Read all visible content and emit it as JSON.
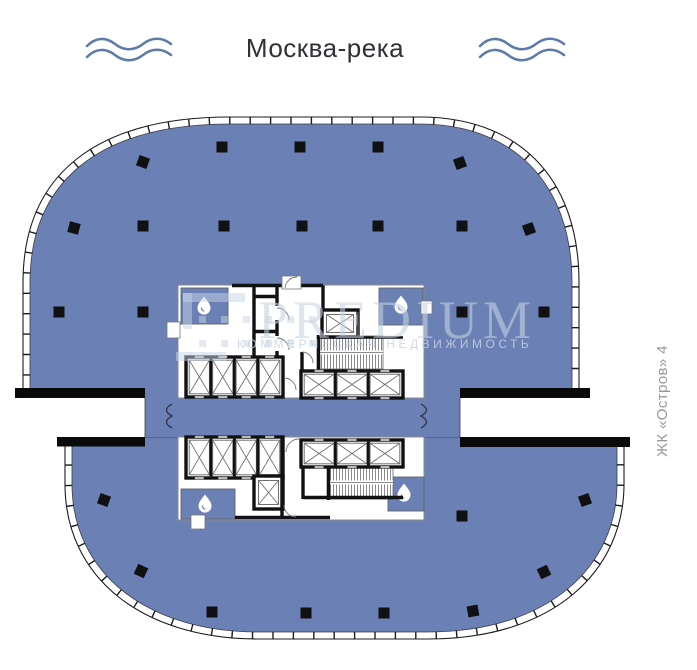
{
  "header": {
    "title": "Москва-река"
  },
  "watermark": {
    "brand": "PREDIUM",
    "tagline": "КОММЕРЧЕСКАЯ НЕДВИЖИМОСТЬ"
  },
  "side_label": {
    "text": "ЖК «Остров» 4"
  },
  "colors": {
    "floor_fill": "#6b80b4",
    "wall": "#111113",
    "outline": "#1c1c1e",
    "wave": "#5d7ba8",
    "title_text": "#303036",
    "side_label_text": "#98989e",
    "watermark": "#c7d3e5",
    "core_line": "#8a8a8a",
    "shaft_line": "#6f6f6f"
  },
  "plan": {
    "columns": [
      {
        "x": 143,
        "y": 162,
        "r": 20
      },
      {
        "x": 222,
        "y": 147,
        "r": 0
      },
      {
        "x": 300,
        "y": 147,
        "r": 0
      },
      {
        "x": 378,
        "y": 147,
        "r": 0
      },
      {
        "x": 460,
        "y": 163,
        "r": -20
      },
      {
        "x": 74,
        "y": 228,
        "r": 15
      },
      {
        "x": 143,
        "y": 226,
        "r": 0
      },
      {
        "x": 224,
        "y": 226,
        "r": 0
      },
      {
        "x": 302,
        "y": 226,
        "r": 0
      },
      {
        "x": 378,
        "y": 226,
        "r": 0
      },
      {
        "x": 462,
        "y": 226,
        "r": 0
      },
      {
        "x": 529,
        "y": 229,
        "r": -20
      },
      {
        "x": 59,
        "y": 312,
        "r": 0
      },
      {
        "x": 143,
        "y": 312,
        "r": 0
      },
      {
        "x": 462,
        "y": 312,
        "r": 0
      },
      {
        "x": 544,
        "y": 312,
        "r": 0
      },
      {
        "x": 104,
        "y": 500,
        "r": 20
      },
      {
        "x": 462,
        "y": 516,
        "r": 0
      },
      {
        "x": 585,
        "y": 500,
        "r": -20
      },
      {
        "x": 141,
        "y": 571,
        "r": 25
      },
      {
        "x": 544,
        "y": 572,
        "r": -25
      },
      {
        "x": 212,
        "y": 612,
        "r": 0
      },
      {
        "x": 306,
        "y": 613,
        "r": 0
      },
      {
        "x": 384,
        "y": 613,
        "r": 0
      },
      {
        "x": 473,
        "y": 611,
        "r": -10
      }
    ],
    "elevator_banks": [
      {
        "x": 186,
        "y": 357,
        "w": 97,
        "h": 40,
        "shafts": 4
      },
      {
        "x": 301,
        "y": 371,
        "w": 102,
        "h": 27,
        "shafts": 3
      },
      {
        "x": 186,
        "y": 437,
        "w": 97,
        "h": 41,
        "shafts": 4
      },
      {
        "x": 301,
        "y": 440,
        "w": 102,
        "h": 27,
        "shafts": 3
      }
    ],
    "single_elevators": [
      {
        "x": 322,
        "y": 310,
        "w": 36,
        "h": 27
      },
      {
        "x": 254,
        "y": 476,
        "w": 29,
        "h": 33
      }
    ],
    "stairwells": [
      {
        "x": 320,
        "y": 336,
        "w": 63,
        "h": 33
      },
      {
        "x": 330,
        "y": 466,
        "w": 63,
        "h": 33
      }
    ],
    "bathrooms": [
      {
        "x": 181,
        "y": 288,
        "w": 47,
        "h": 36,
        "dx": 204,
        "dy": 305
      },
      {
        "x": 379,
        "y": 288,
        "w": 44,
        "h": 37,
        "dx": 401,
        "dy": 304
      },
      {
        "x": 181,
        "y": 489,
        "w": 54,
        "h": 30,
        "dx": 205,
        "dy": 503
      },
      {
        "x": 388,
        "y": 477,
        "w": 36,
        "h": 34,
        "dx": 404,
        "dy": 492
      }
    ]
  }
}
